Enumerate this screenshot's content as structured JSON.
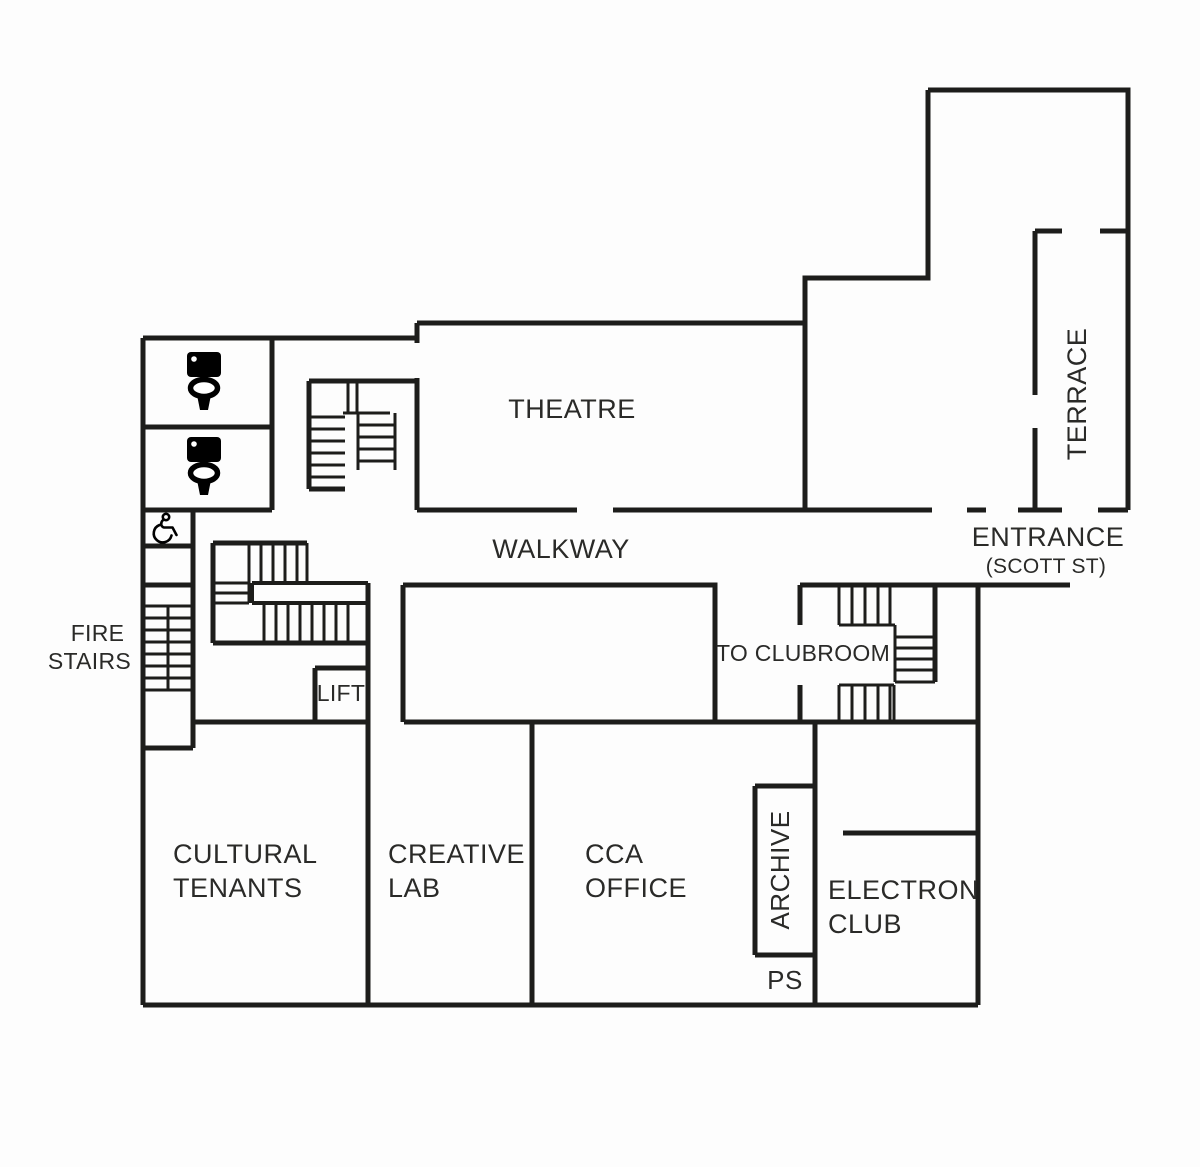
{
  "page": {
    "title": "Building floor plan"
  },
  "colors": {
    "wall": "#1d1d1b",
    "text": "#2a2a28",
    "background": "#fdfdfd"
  },
  "rooms": {
    "theatre": {
      "label": "THEATRE"
    },
    "walkway": {
      "label": "WALKWAY"
    },
    "terrace": {
      "label": "TERRACE"
    },
    "entrance": {
      "label": "ENTRANCE",
      "sublabel": "(SCOTT ST)"
    },
    "fire_stairs": {
      "line1": "FIRE",
      "line2": "STAIRS"
    },
    "to_clubroom": {
      "label": "TO CLUBROOM"
    },
    "lift": {
      "label": "LIFT"
    },
    "cultural_tenants": {
      "line1": "CULTURAL",
      "line2": "TENANTS"
    },
    "creative_lab": {
      "line1": "CREATIVE",
      "line2": "LAB"
    },
    "cca_office": {
      "line1": "CCA",
      "line2": "OFFICE"
    },
    "archive": {
      "label": "ARCHIVE"
    },
    "ps": {
      "label": "PS"
    },
    "electron_club": {
      "line1": "ELECTRON",
      "line2": "CLUB"
    }
  },
  "icons": {
    "toilet_upper": "toilet-icon",
    "toilet_lower": "toilet-icon",
    "accessible_wc": "wheelchair-icon"
  }
}
